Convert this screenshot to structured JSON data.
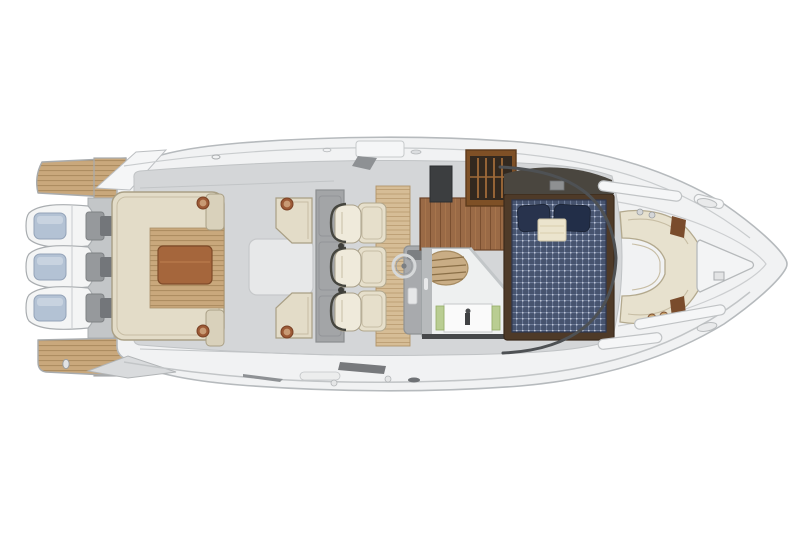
{
  "meta": {
    "title": "Yacht deck and cabin floor plan — top-down rendering",
    "view": "overhead",
    "orientation": "bow-right-stern-left",
    "background": "#ffffff",
    "canvas": {
      "width": 800,
      "height": 533
    }
  },
  "palette": {
    "bg": "#ffffff",
    "hull_fill": "#f1f2f3",
    "hull_line": "#b6babd",
    "hull_shade": "#d9dbdd",
    "deck_sole": "#d4d6d8",
    "seam_line": "#c2c5c7",
    "platform_teak": "#c9a87c",
    "platform_line": "#aa8a5e",
    "teak_light": "#d6bd96",
    "teak_line": "#bb9e74",
    "upholstery": "#e3dcc8",
    "upholstery_hi": "#efeadb",
    "upholstery_line": "#a99f85",
    "cushion_seam": "#c7bda4",
    "table_wood": "#a5663c",
    "cabinet_wood": "#7e5026",
    "cabinet_dark": "#33291f",
    "floor_wood": "#9a6a46",
    "floor_wood_line": "#7a4f30",
    "berth_navy": "#46536e",
    "berth_grid": "#7f8cab",
    "pillow_navy": "#28334d",
    "towel": "#ebe4cd",
    "engine_white": "#f4f5f5",
    "engine_cap": "#b3c2d4",
    "bracket_gray": "#96999c",
    "console_gray": "#a8aaad",
    "wetbar_gray": "#a3a5a7",
    "appliance_dark": "#3c3e40",
    "headliner_dark": "#4a463f",
    "green_glass": "#b9cd92",
    "chrome": "#d6d8d9",
    "windshield_frame": "#4e5154",
    "speaker_ring": "#9c5a36",
    "speaker_cone": "#c89a74",
    "bath_floor": "#eef0f0",
    "white_deck": "#f5f6f7"
  },
  "features": {
    "engines": {
      "count": 3,
      "label": "triple outboard engines"
    },
    "swim_platform": {
      "label": "teak swim platform"
    },
    "aft_settee": {
      "label": "aft U-shaped settee"
    },
    "cockpit_table": {
      "label": "cockpit teak table"
    },
    "deck_hatch": {
      "label": "cockpit in-sole hatch"
    },
    "chaise_seats": {
      "count": 2,
      "label": "back-to-back chaise seats"
    },
    "speakers": {
      "count": 4,
      "label": "cockpit speakers"
    },
    "wet_bar": {
      "label": "wet bar / galley module"
    },
    "helm_seats": {
      "count": 3,
      "label": "helm bucket seats"
    },
    "helm_console": {
      "label": "helm console with steering wheel"
    },
    "galley": {
      "label": "below-deck galley with stowage cabinet"
    },
    "companionway": {
      "label": "companionway steps"
    },
    "head": {
      "label": "head compartment with vanity sink"
    },
    "berth": {
      "label": "forward double berth with pillows and towel"
    },
    "bow_lounge": {
      "label": "wraparound bow lounge"
    },
    "anchor_locker": {
      "label": "anchor locker hatch"
    },
    "windshield": {
      "label": "wraparound windshield"
    },
    "grab_rails": {
      "count": 4,
      "label": "foredeck grab rails"
    }
  }
}
